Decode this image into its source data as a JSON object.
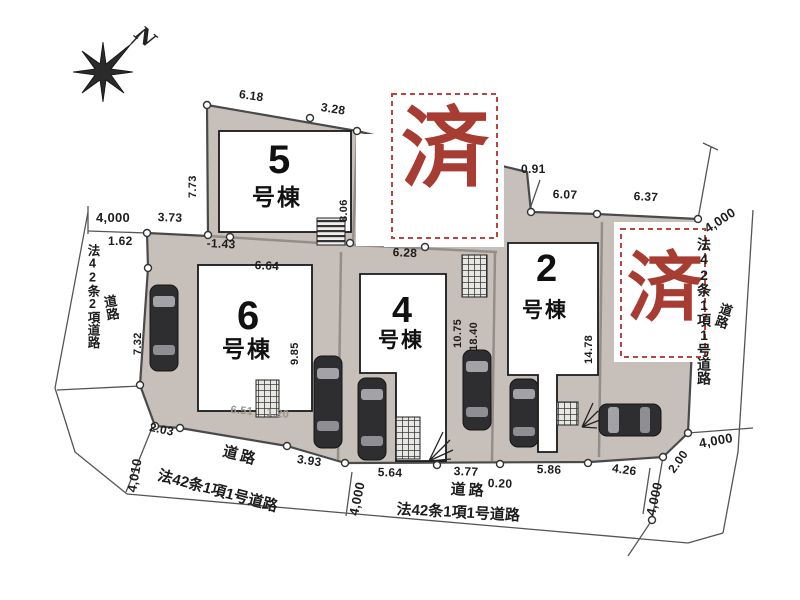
{
  "compass": {
    "north_label": "N"
  },
  "stamps": {
    "sold": "済"
  },
  "buildings": {
    "b5": {
      "number": "5",
      "suffix": "号棟"
    },
    "b6": {
      "number": "6",
      "suffix": "号棟"
    },
    "b4": {
      "number": "4",
      "suffix": "号棟"
    },
    "b2": {
      "number": "2",
      "suffix": "号棟"
    }
  },
  "roads": {
    "left_law": "法42条2項道路",
    "left_label": "道路",
    "right_law": "法42条1項1号道路",
    "right_label": "道路",
    "bottom_left_label": "道路",
    "bottom_left_law": "法42条1項1号道路",
    "bottom_center_label": "道路",
    "bottom_center_law": "法42条1項1号道路"
  },
  "dimensions": {
    "d618": "6.18",
    "d328": "3.28",
    "d773": "7.73",
    "d091": "0.91",
    "d607": "6.07",
    "d637": "6.37",
    "d4000tl": "4,000",
    "d373": "3.73",
    "d162": "1.62",
    "dm143": "-1.43",
    "d664": "6.64",
    "d732": "7.32",
    "d806": "8.06",
    "d628": "6.28",
    "d985": "9.85",
    "d1075": "10.75",
    "d1840": "18.40",
    "d1478": "14.78",
    "d4000tr": "4,000",
    "d203": "2.03",
    "d4010": "4,010",
    "d393": "3.93",
    "d564": "5.64",
    "d377": "3.77",
    "d020": "0.20",
    "d586": "5.86",
    "d426": "4.26",
    "d200": "2.00",
    "d4000brh": "4,000",
    "d4000brv": "4,000",
    "d4000bc": "4,000",
    "d651": "6.51",
    "d120": "1.20"
  },
  "colors": {
    "stamp_red": "#a63c32",
    "lot_fill": "#c7c0ba",
    "outline": "#4a4a4a"
  }
}
